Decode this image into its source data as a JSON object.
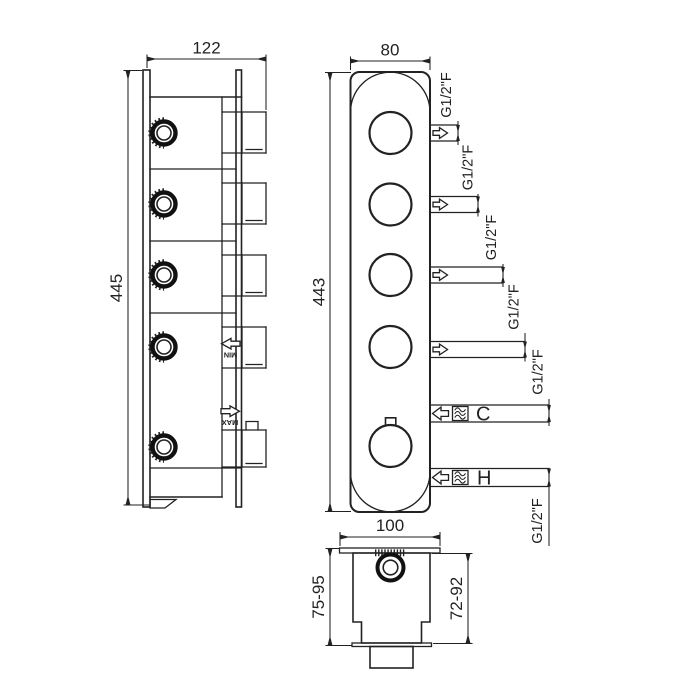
{
  "side_view": {
    "width_mm": "122",
    "height_mm": "445",
    "min_label": "MIN",
    "max_label": "MAX"
  },
  "front_view": {
    "width_mm": "80",
    "height_mm": "443",
    "outlets": [
      {
        "thread": "G1/2\"F"
      },
      {
        "thread": "G1/2\"F"
      },
      {
        "thread": "G1/2\"F"
      },
      {
        "thread": "G1/2\"F"
      }
    ],
    "cold_inlet": {
      "label": "C",
      "thread": "G1/2\"F"
    },
    "hot_inlet": {
      "label": "H",
      "thread": "G1/2\"F"
    }
  },
  "bottom_view": {
    "width_mm": "100",
    "depth_range_left": "75-95",
    "depth_range_right": "72-92"
  },
  "colors": {
    "line": "#222222",
    "background": "#ffffff"
  }
}
